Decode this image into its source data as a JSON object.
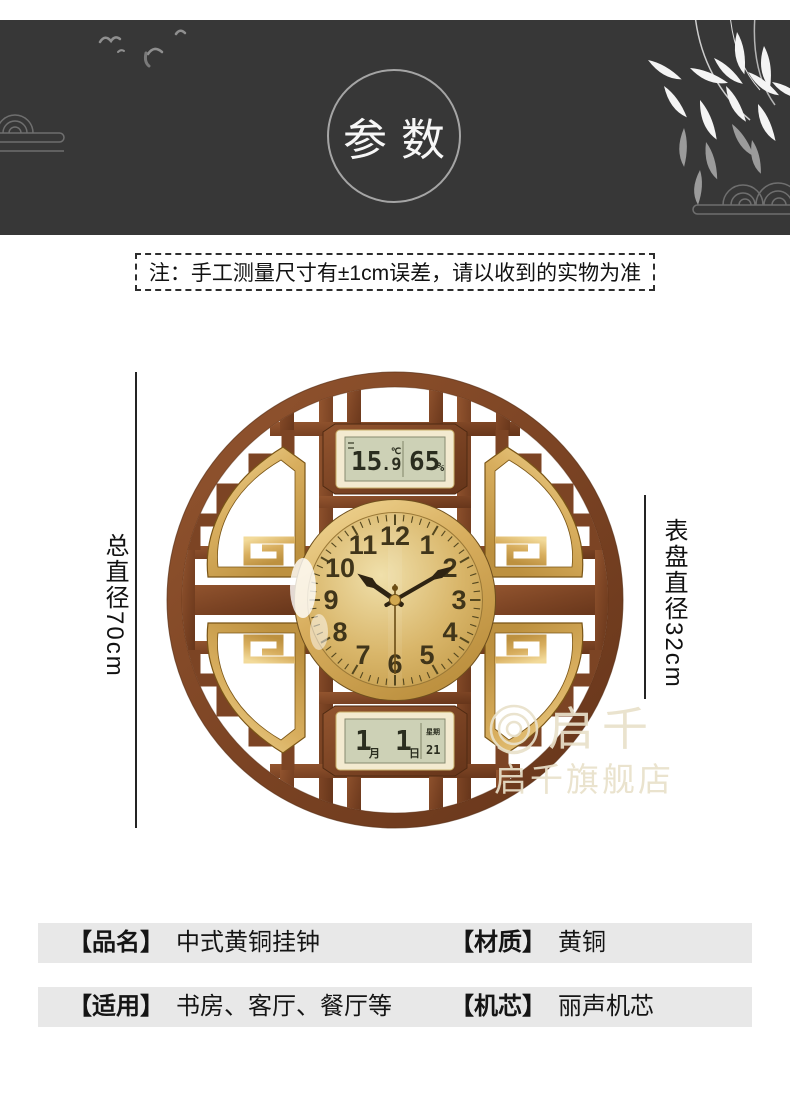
{
  "header": {
    "badge_label": "参数",
    "background_color": "#373737",
    "decorations": [
      "birds-icon",
      "cloud-left-icon",
      "cloud-right-icon",
      "bamboo-icon"
    ]
  },
  "note": {
    "text": "注：手工测量尺寸有±1cm误差，请以收到的实物为准"
  },
  "diagram": {
    "left_dimension_label": "总直径70cm",
    "right_dimension_label": "表盘直径32cm",
    "clock": {
      "numerals": [
        "12",
        "1",
        "2",
        "3",
        "4",
        "5",
        "6",
        "7",
        "8",
        "9",
        "10",
        "11"
      ],
      "time": {
        "hour": 10,
        "minute": 10,
        "second": 30
      },
      "top_lcd": {
        "temp_main": "15",
        "temp_decimal": ".9",
        "temp_unit": "℃",
        "humidity": "65",
        "humidity_unit": "%"
      },
      "bottom_lcd": {
        "month_num": "1",
        "month_char": "月",
        "day_num": "1",
        "day_char": "日",
        "week_label": "星期",
        "week_value": "21"
      },
      "colors": {
        "wood": "#7c4424",
        "wood_dark": "#5a2f15",
        "gold": "#d8ae5e",
        "dial": "#d9b66a",
        "lcd_screen": "#cdd1b6",
        "lcd_bezel": "#f3ead0"
      }
    },
    "watermark": {
      "brand": "启千",
      "store": "启千旗舰店"
    }
  },
  "specs": {
    "rows": [
      {
        "left_label": "【品名】",
        "left_value": "中式黄铜挂钟",
        "right_label": "【材质】",
        "right_value": "黄铜"
      },
      {
        "left_label": "【适用】",
        "left_value": "书房、客厅、餐厅等",
        "right_label": "【机芯】",
        "right_value": "丽声机芯"
      }
    ]
  }
}
